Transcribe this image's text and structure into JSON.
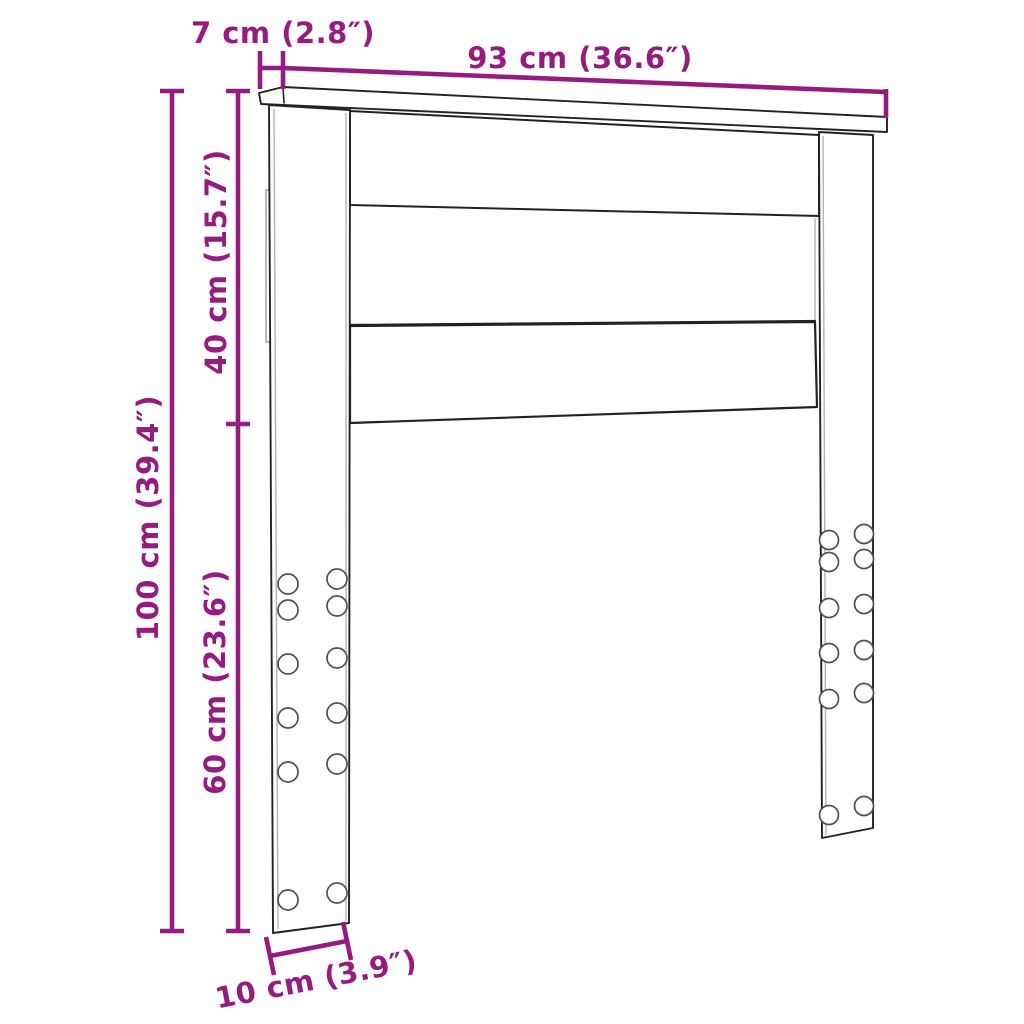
{
  "diagram": {
    "kind": "product-dimension-diagram",
    "product": "bed-headboard",
    "accent_color": "#951b81",
    "outline_color": "#222222",
    "secondary_line_color": "#b3b3b3",
    "background_color": "#ffffff",
    "dimensions": {
      "top_depth": {
        "label": "7 cm (2.8″)",
        "value_cm": 7,
        "value_in": 2.8
      },
      "width": {
        "label": "93 cm (36.6″)",
        "value_cm": 93,
        "value_in": 36.6
      },
      "panel_height": {
        "label": "40 cm (15.7″)",
        "value_cm": 40,
        "value_in": 15.7
      },
      "total_height": {
        "label": "100 cm (39.4″)",
        "value_cm": 100,
        "value_in": 39.4
      },
      "leg_height": {
        "label": "60 cm (23.6″)",
        "value_cm": 60,
        "value_in": 23.6
      },
      "leg_depth": {
        "label": "10 cm (3.9″)",
        "value_cm": 10,
        "value_in": 3.9
      }
    },
    "features": {
      "slat_count": 3,
      "legs": 2,
      "bolt_holes_per_leg": 12
    }
  }
}
